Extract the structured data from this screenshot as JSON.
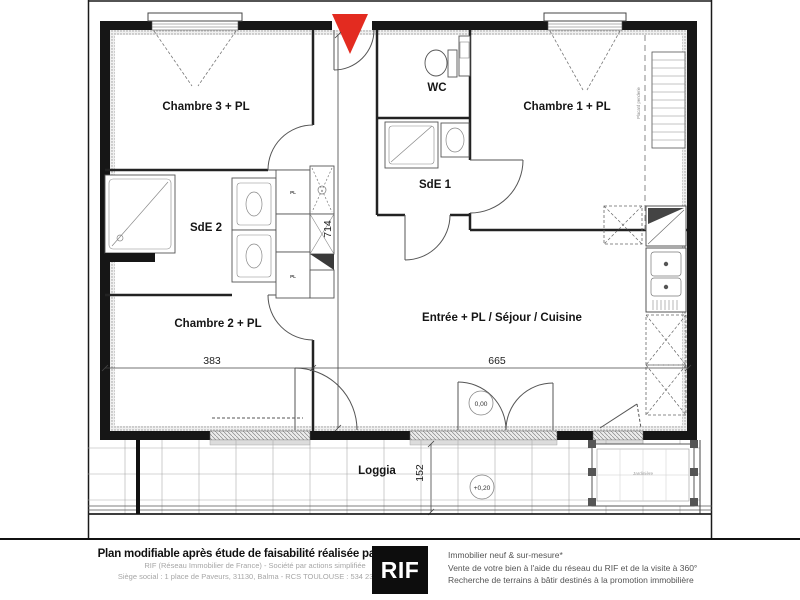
{
  "plan": {
    "rooms": {
      "chambre3": "Chambre 3 + PL",
      "wc": "WC",
      "chambre1": "Chambre 1 + PL",
      "sde1": "SdE 1",
      "sde2": "SdE 2",
      "chambre2": "Chambre 2 + PL",
      "sejour": "Entrée + PL / Séjour / Cuisine",
      "loggia": "Loggia",
      "jardiniere": "Jardinière"
    },
    "closets": {
      "pl_top": "PL",
      "pl_bottom": "PL",
      "note_vertical": "Placard penderie"
    },
    "dimensions": {
      "chambre2_width": "383",
      "sejour_width": "665",
      "depth": "714",
      "loggia_depth": "152"
    },
    "levels": {
      "interior": "0,00",
      "loggia": "+0,20"
    },
    "colors": {
      "entrance_arrow": "#e32b20",
      "walls": "#161616"
    }
  },
  "footer": {
    "left": {
      "title": "Plan modifiable après étude de faisabilité réalisée par le RIF",
      "line2": "RIF (Réseau Immobilier de France) - Société par actions simplifiée",
      "line3": "Siège social : 1 place de Paveurs, 31130, Balma - RCS TOULOUSE : 534 234 174"
    },
    "logo": "RIF",
    "right": {
      "line1": "Immobilier neuf & sur-mesure*",
      "line2": "Vente de votre bien à l'aide du réseau du RIF et de la visite à 360°",
      "line3": "Recherche de terrains à bâtir destinés à la promotion immobilière"
    }
  }
}
